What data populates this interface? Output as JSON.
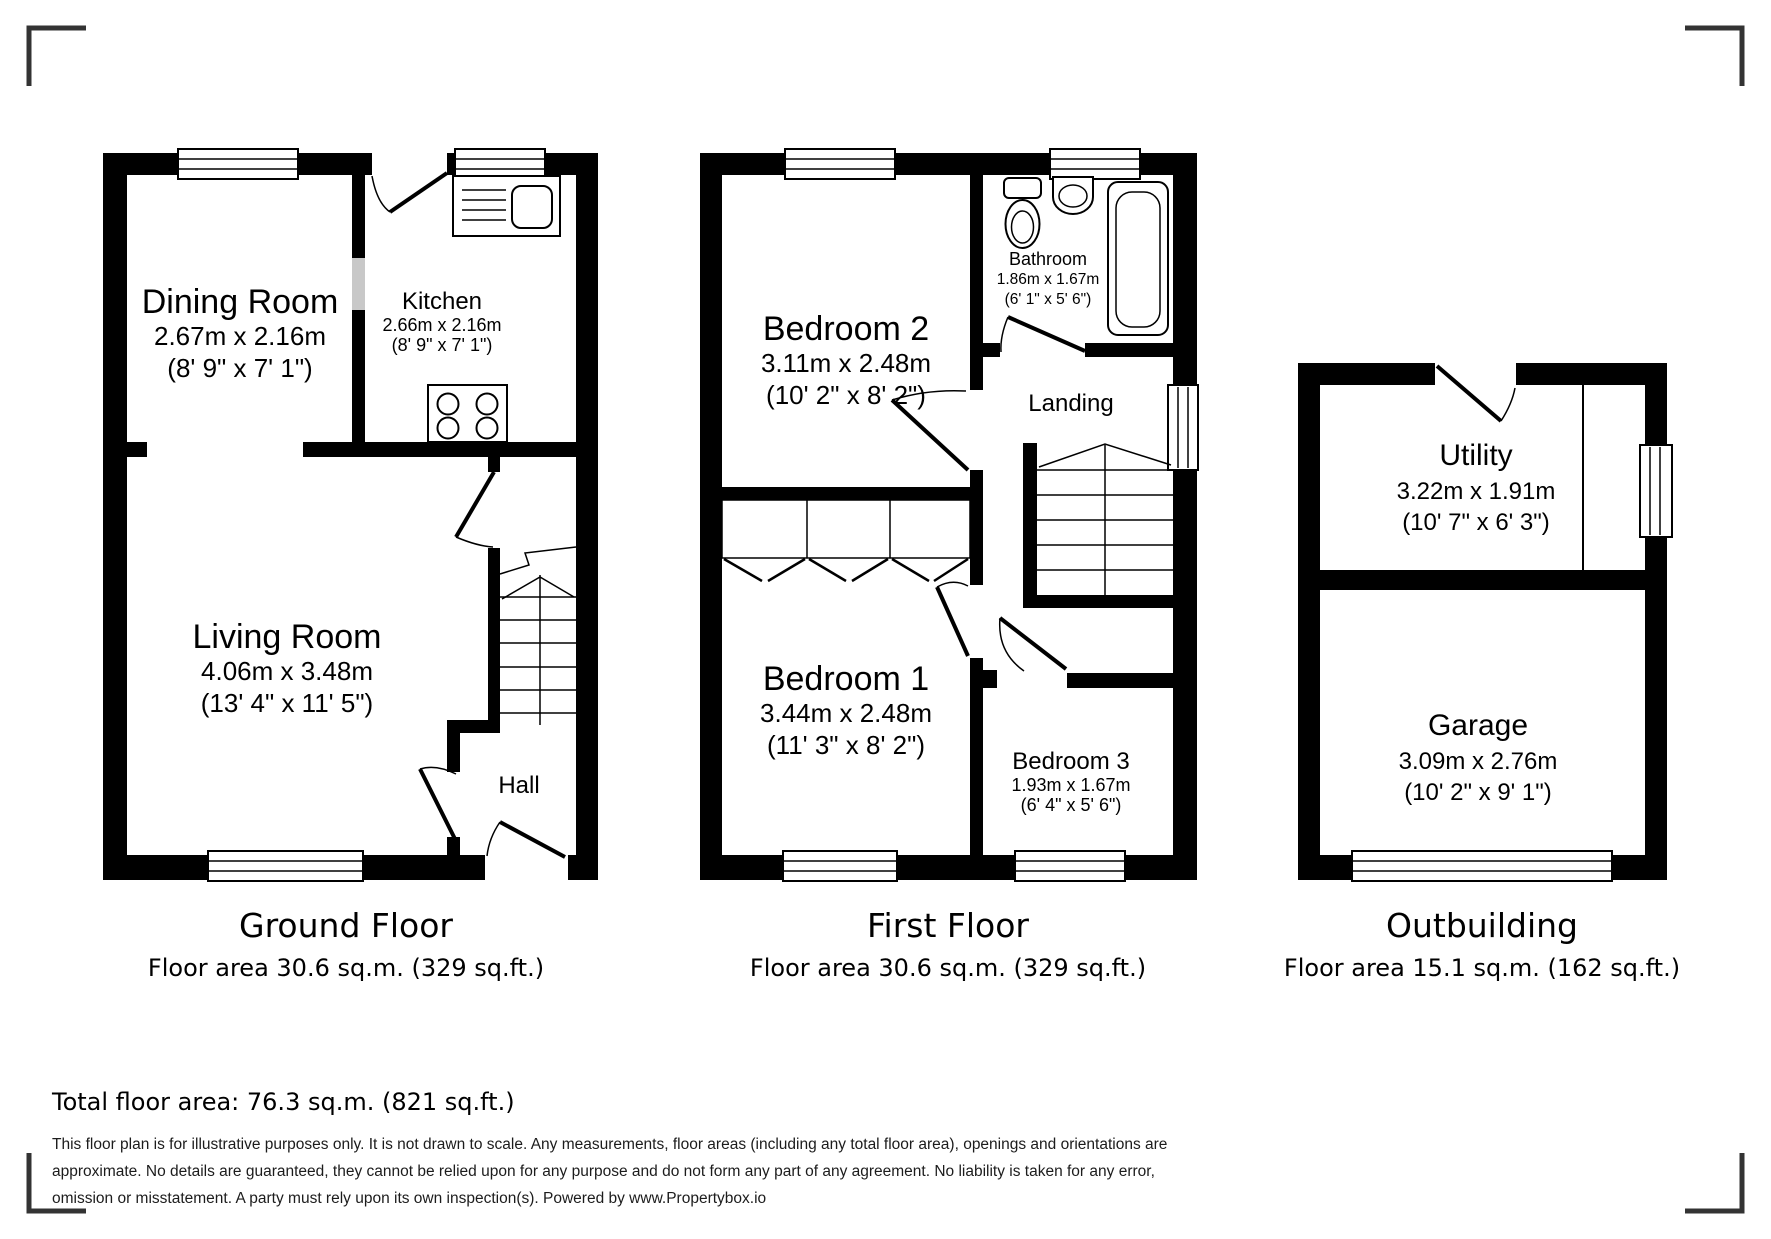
{
  "rooms": {
    "dining": {
      "name": "Dining Room",
      "metric": "2.67m x 2.16m",
      "imperial": "(8' 9\" x 7' 1\")"
    },
    "kitchen": {
      "name": "Kitchen",
      "metric": "2.66m x 2.16m",
      "imperial": "(8' 9\" x 7' 1\")"
    },
    "living": {
      "name": "Living Room",
      "metric": "4.06m x 3.48m",
      "imperial": "(13' 4\" x 11' 5\")"
    },
    "hall": {
      "name": "Hall"
    },
    "bedroom2": {
      "name": "Bedroom 2",
      "metric": "3.11m x 2.48m",
      "imperial": "(10' 2\" x 8' 2\")"
    },
    "bathroom": {
      "name": "Bathroom",
      "metric": "1.86m x 1.67m",
      "imperial": "(6' 1\" x 5' 6\")"
    },
    "landing": {
      "name": "Landing"
    },
    "bedroom1": {
      "name": "Bedroom 1",
      "metric": "3.44m x 2.48m",
      "imperial": "(11' 3\" x 8' 2\")"
    },
    "bedroom3": {
      "name": "Bedroom 3",
      "metric": "1.93m x 1.67m",
      "imperial": "(6' 4\" x 5' 6\")"
    },
    "utility": {
      "name": "Utility",
      "metric": "3.22m x 1.91m",
      "imperial": "(10' 7\" x 6' 3\")"
    },
    "garage": {
      "name": "Garage",
      "metric": "3.09m x 2.76m",
      "imperial": "(10' 2\" x 9' 1\")"
    }
  },
  "floors": [
    {
      "title": "Ground Floor",
      "area": "Floor area 30.6 sq.m. (329 sq.ft.)"
    },
    {
      "title": "First Floor",
      "area": "Floor area 30.6 sq.m. (329 sq.ft.)"
    },
    {
      "title": "Outbuilding",
      "area": "Floor area 15.1 sq.m. (162 sq.ft.)"
    }
  ],
  "summary": {
    "total_floor_area": "Total floor area: 76.3 sq.m. (821 sq.ft.)"
  },
  "disclaimer": {
    "line1": "This floor plan is for illustrative purposes only. It is not drawn to scale. Any measurements, floor areas (including any total floor area), openings and orientations are",
    "line2": "approximate. No details are guaranteed, they cannot be relied upon for any purpose and do not form any part of any agreement. No liability is taken for any error,",
    "line3": "omission or misstatement. A party must rely upon its own inspection(s). Powered by www.Propertybox.io"
  },
  "icons": {
    "sink": "kitchen-sink-drainer",
    "stove": "four-burner-hob",
    "toilet": "toilet",
    "basin": "wash-basin",
    "bathtub": "bathtub",
    "stairs": "staircase-with-up-break",
    "wardrobe": "built-in-wardrobe",
    "window": "double-line-window",
    "door": "door-swing-arc"
  },
  "colors": {
    "wall": "#000000",
    "wall_opening": "#c8c8c8",
    "corner_mark": "#333333",
    "background": "#ffffff"
  }
}
